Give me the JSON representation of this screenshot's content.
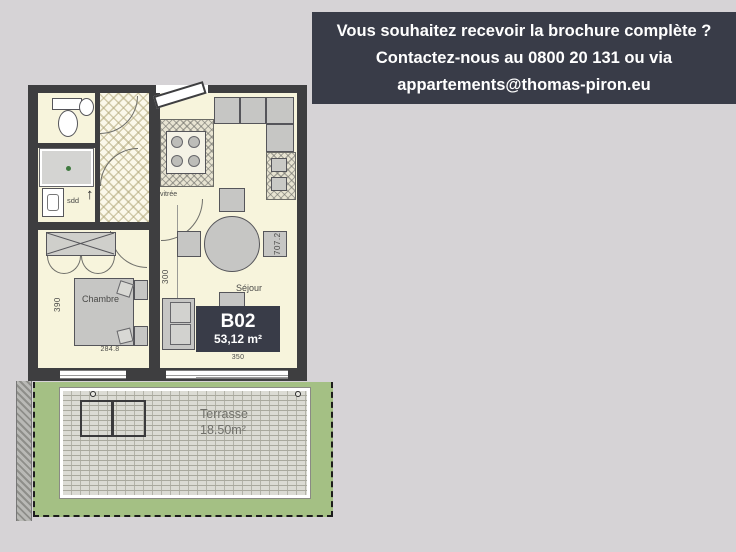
{
  "banner": {
    "line1": "Vous souhaitez recevoir la brochure complète ?",
    "line2": "Contactez-nous au 0800 20 131 ou via",
    "line3": "appartements@thomas-piron.eu"
  },
  "unit": {
    "code": "B02",
    "area": "53,12 m²"
  },
  "rooms": {
    "bedroom": "Chambre",
    "living": "Séjour",
    "shower_room": "sdd",
    "glazed_door": "vitrée",
    "terrace": "Terrasse",
    "terrace_area": "18.50m²"
  },
  "dimensions": {
    "bedroom_width": "390",
    "bedroom_length": "284.8",
    "living_section": "300",
    "living_length": "707.2",
    "living_width": "350"
  },
  "icons": {
    "direction_arrow": "↑"
  },
  "colors": {
    "background": "#d6d3d6",
    "banner_bg": "#393c48",
    "badge_bg": "#393c48",
    "wall": "#3e3e40",
    "floor": "#f7f4dc",
    "terrace_green": "#a4c084"
  }
}
